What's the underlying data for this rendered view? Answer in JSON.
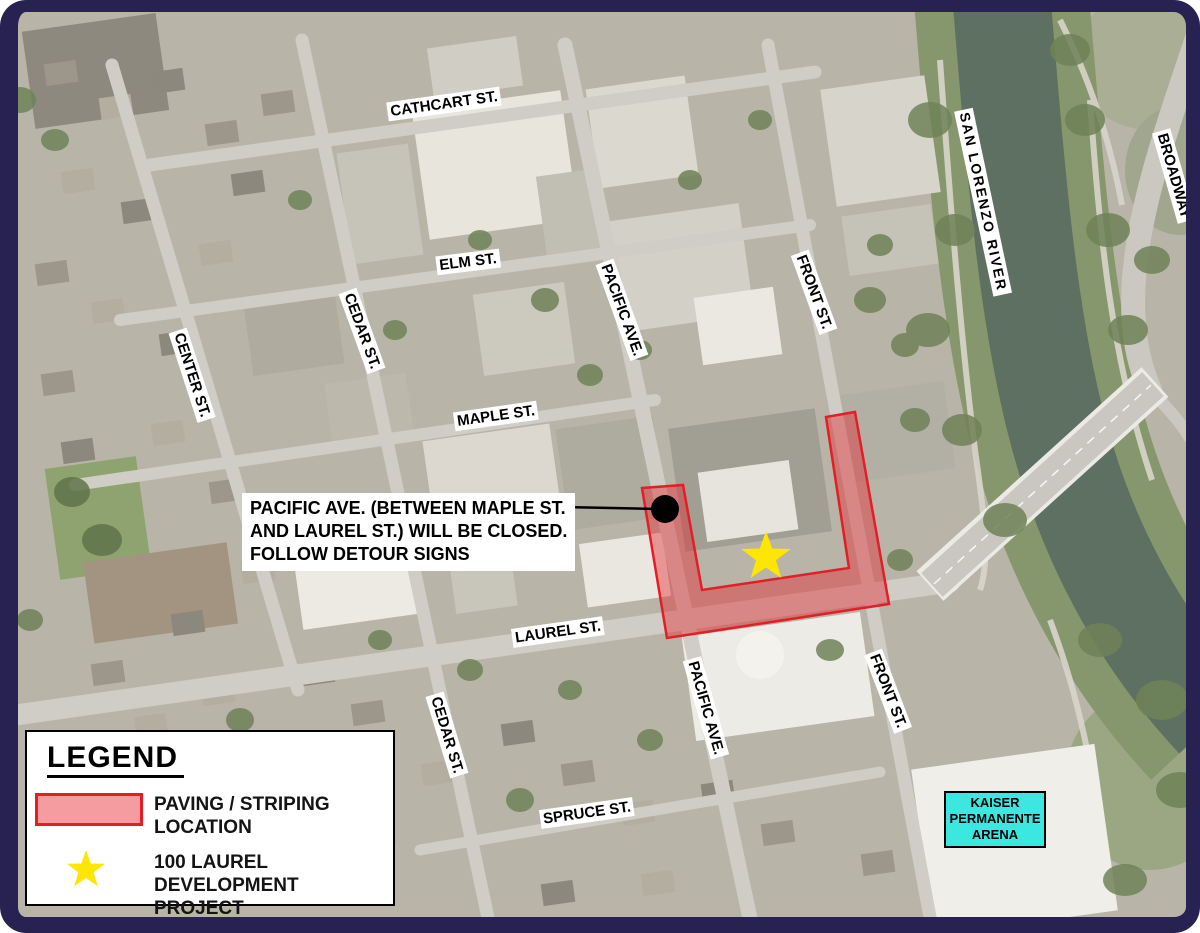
{
  "map": {
    "streets": {
      "cathcart": "CATHCART ST.",
      "elm": "ELM ST.",
      "maple": "MAPLE ST.",
      "laurel": "LAUREL ST.",
      "spruce": "SPRUCE ST.",
      "center": "CENTER ST.",
      "cedar": "CEDAR ST.",
      "pacific": "PACIFIC AVE.",
      "front": "FRONT ST.",
      "broadway": "BROADWAY",
      "river": "SAN LORENZO RIVER"
    },
    "callout": {
      "line1": "PACIFIC AVE. (BETWEEN MAPLE ST.",
      "line2": "AND LAUREL ST.) WILL BE CLOSED.",
      "line3": "FOLLOW DETOUR SIGNS"
    },
    "kaiser": {
      "line1": "KAISER",
      "line2": "PERMANENTE",
      "line3": "ARENA"
    }
  },
  "legend": {
    "title": "LEGEND",
    "items": [
      {
        "symbol": "paving-swatch",
        "line1": "PAVING / STRIPING",
        "line2": "LOCATION"
      },
      {
        "symbol": "yellow-star",
        "line1": "100 LAUREL",
        "line2": "DEVELOPMENT PROJECT"
      }
    ]
  },
  "colors": {
    "frame": "#272251",
    "paving_fill": "#e8232d",
    "paving_border": "#e31e26",
    "star": "#ffe600",
    "kaiser_background": "#3be7df",
    "label_background": "#ffffff",
    "label_text": "#000000"
  }
}
